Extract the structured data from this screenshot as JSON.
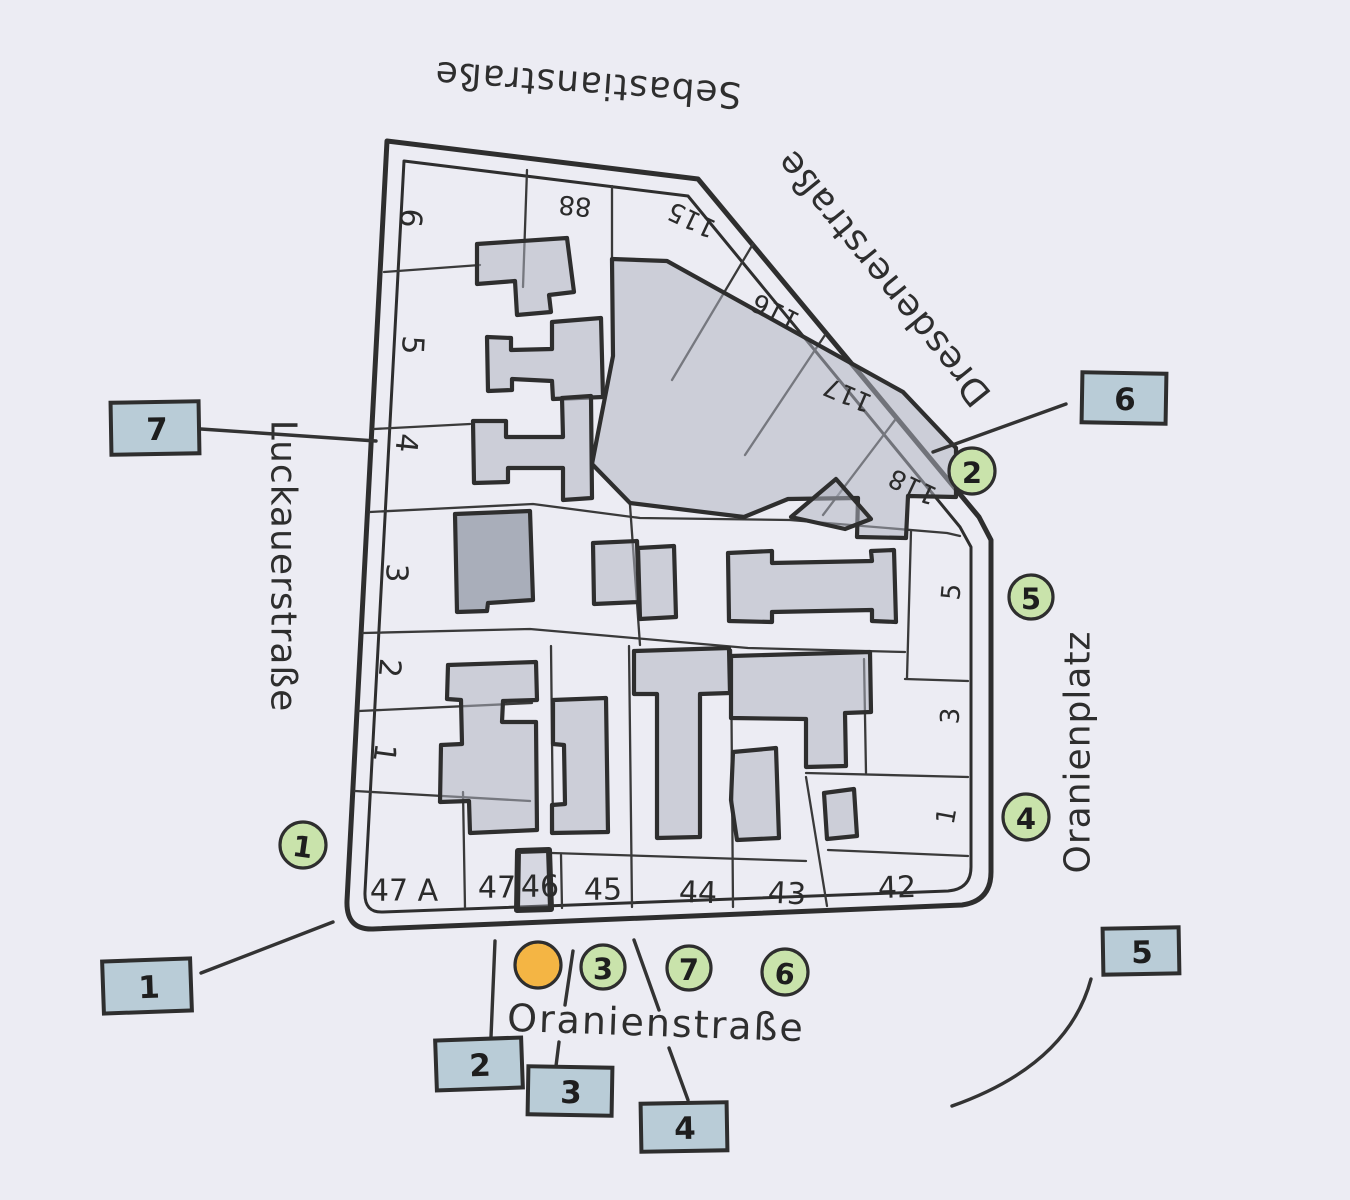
{
  "map": {
    "title_context": "Hand-drawn block map of Oranienplatz area",
    "streets": {
      "top": "Sebastianstraße",
      "diagonal": "Dresdenerstraße",
      "left": "Luckauerstraße",
      "right": "Oranienplatz",
      "bottom": "Oranienstraße"
    },
    "plots": {
      "left_column": [
        "6",
        "5",
        "4",
        "3",
        "2",
        "1"
      ],
      "top_row": [
        "88",
        "115",
        "116",
        "117",
        "118"
      ],
      "right_column": [
        "5",
        "3",
        "1"
      ],
      "bottom_row": [
        "47 A",
        "47",
        "46",
        "45",
        "44",
        "43",
        "42"
      ]
    },
    "green_markers": [
      "1",
      "2",
      "3",
      "4",
      "5",
      "6",
      "7"
    ],
    "orange_marker": "",
    "blue_labels": [
      "1",
      "2",
      "3",
      "4",
      "5",
      "6",
      "7"
    ]
  },
  "colors": {
    "paper": "#ececf3",
    "ink": "#2e2e2e",
    "building_gray": "#aeb3bf",
    "building_dark": "#8f96a4",
    "marker_green": "#c9e3ab",
    "label_blue": "#b9ccd7",
    "marker_orange": "#f4b544"
  }
}
